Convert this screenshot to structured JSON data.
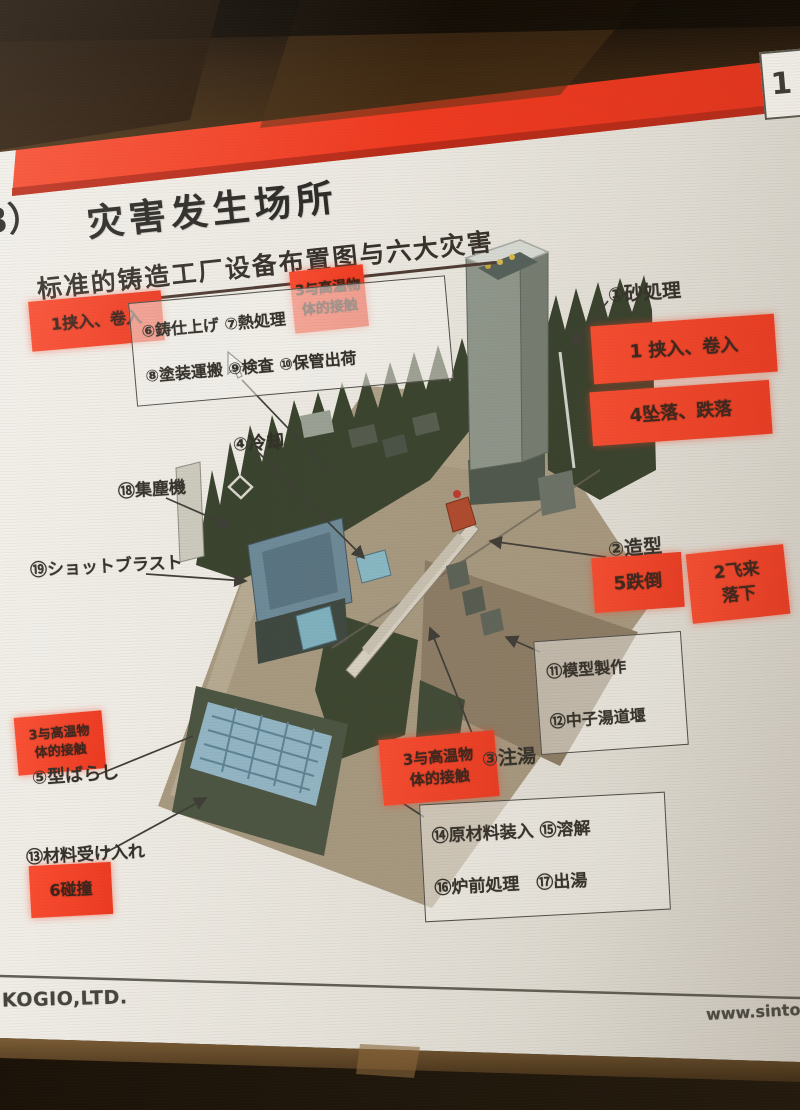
{
  "page": {
    "number": "1"
  },
  "slide": {
    "title_prefix": "3）",
    "title": "灾害发生场所",
    "subtitle": "标准的铸造工厂设备布置图与六大灾害",
    "footer_left": "KOGIO,LTD.",
    "footer_right": "www.sinto.c"
  },
  "colors": {
    "banner_red": "#ef3a20",
    "hazard_red": "#f4472c"
  },
  "labels": [
    {
      "id": "hazard-pinch-left",
      "type": "hazard",
      "lines": [
        "1挟入、卷入"
      ],
      "x": 30,
      "y": 296,
      "w": 133,
      "h": 50,
      "rot": -5,
      "fs": 16
    },
    {
      "id": "hazard-hot-top",
      "type": "hazard",
      "lines": [
        "3与高温物",
        "体的接触"
      ],
      "x": 292,
      "y": 268,
      "w": 74,
      "h": 62,
      "rot": -6,
      "fs": 14
    },
    {
      "id": "hazard-pinch-right",
      "type": "hazard",
      "lines": [
        "1 挟入、卷入"
      ],
      "x": 592,
      "y": 320,
      "w": 184,
      "h": 58,
      "rot": -4,
      "fs": 18
    },
    {
      "id": "hazard-fall-right",
      "type": "hazard",
      "lines": [
        "4坠落、跌落"
      ],
      "x": 591,
      "y": 386,
      "w": 180,
      "h": 54,
      "rot": -4,
      "fs": 18
    },
    {
      "id": "hazard-trip",
      "type": "hazard",
      "lines": [
        "5跌倒"
      ],
      "x": 593,
      "y": 555,
      "w": 90,
      "h": 55,
      "rot": -4,
      "fs": 18
    },
    {
      "id": "hazard-flying",
      "type": "hazard",
      "lines": [
        "2飞来",
        "落下"
      ],
      "x": 689,
      "y": 549,
      "w": 98,
      "h": 70,
      "rot": -6,
      "fs": 17
    },
    {
      "id": "hazard-hot-mid",
      "type": "hazard",
      "lines": [
        "3与高温物",
        "体的接触"
      ],
      "x": 381,
      "y": 735,
      "w": 116,
      "h": 66,
      "rot": -5,
      "fs": 15
    },
    {
      "id": "hazard-hot-left",
      "type": "hazard",
      "lines": [
        "3与高温物",
        "体的接触"
      ],
      "x": 16,
      "y": 714,
      "w": 88,
      "h": 58,
      "rot": -5,
      "fs": 13
    },
    {
      "id": "hazard-collision",
      "type": "hazard",
      "lines": [
        "6碰撞"
      ],
      "x": 30,
      "y": 864,
      "w": 82,
      "h": 52,
      "rot": -3,
      "fs": 16
    },
    {
      "id": "process-finishing-box",
      "type": "pbox",
      "lines": [
        "⑥鋳仕上げ ⑦熱処理",
        "⑧塗装運搬 ⑨検査 ⑩保管出荷"
      ],
      "x": 132,
      "y": 289,
      "w": 296,
      "h": 90,
      "rot": -5,
      "fs": 16
    },
    {
      "id": "process-pattern-box",
      "type": "pbox",
      "lines": [
        "⑪模型製作",
        "⑫中子湯道堰"
      ],
      "x": 537,
      "y": 636,
      "w": 126,
      "h": 100,
      "rot": -4,
      "fs": 16
    },
    {
      "id": "process-melting-box",
      "type": "pbox",
      "lines": [
        "⑭原材料装入 ⑮溶解",
        "⑯炉前処理　⑰出湯"
      ],
      "x": 422,
      "y": 798,
      "w": 224,
      "h": 104,
      "rot": -3,
      "fs": 17
    },
    {
      "id": "label-sand-processing",
      "type": "plain",
      "lines": [
        "①砂処理"
      ],
      "x": 608,
      "y": 283,
      "rot": -4,
      "fs": 19
    },
    {
      "id": "label-molding",
      "type": "plain",
      "lines": [
        "②造型"
      ],
      "x": 608,
      "y": 538,
      "rot": -4,
      "fs": 19
    },
    {
      "id": "label-pouring",
      "type": "plain",
      "lines": [
        "③注湯"
      ],
      "x": 482,
      "y": 748,
      "rot": -4,
      "fs": 19
    },
    {
      "id": "label-cooling",
      "type": "plain",
      "lines": [
        "④冷却"
      ],
      "x": 233,
      "y": 434,
      "rot": -4,
      "fs": 18
    },
    {
      "id": "label-shakeout",
      "type": "plain",
      "lines": [
        "⑤型ばらし"
      ],
      "x": 32,
      "y": 766,
      "rot": -4,
      "fs": 18
    },
    {
      "id": "label-dust-collector",
      "type": "plain",
      "lines": [
        "⑱集塵機"
      ],
      "x": 118,
      "y": 481,
      "rot": -4,
      "fs": 17
    },
    {
      "id": "label-shot-blast",
      "type": "plain",
      "lines": [
        "⑲ショットブラスト"
      ],
      "x": 30,
      "y": 558,
      "rot": -3,
      "fs": 17
    },
    {
      "id": "label-material-receiving",
      "type": "plain",
      "lines": [
        "⑬材料受け入れ"
      ],
      "x": 26,
      "y": 846,
      "rot": -3,
      "fs": 17
    }
  ],
  "arrows": [
    {
      "x1": 608,
      "y1": 301,
      "x2": 572,
      "y2": 346,
      "head": true
    },
    {
      "x1": 606,
      "y1": 557,
      "x2": 490,
      "y2": 541,
      "head": true
    },
    {
      "x1": 481,
      "y1": 756,
      "x2": 430,
      "y2": 628,
      "head": true
    },
    {
      "x1": 258,
      "y1": 452,
      "x2": 364,
      "y2": 558,
      "head": true
    },
    {
      "x1": 166,
      "y1": 498,
      "x2": 230,
      "y2": 526,
      "head": true
    },
    {
      "x1": 146,
      "y1": 574,
      "x2": 246,
      "y2": 581,
      "head": true
    },
    {
      "x1": 97,
      "y1": 775,
      "x2": 193,
      "y2": 736,
      "head": false
    },
    {
      "x1": 105,
      "y1": 853,
      "x2": 206,
      "y2": 798,
      "head": true
    },
    {
      "x1": 540,
      "y1": 652,
      "x2": 506,
      "y2": 637,
      "head": true
    },
    {
      "x1": 242,
      "y1": 380,
      "x2": 328,
      "y2": 470,
      "head": false
    },
    {
      "x1": 398,
      "y1": 800,
      "x2": 424,
      "y2": 817,
      "head": false
    }
  ]
}
